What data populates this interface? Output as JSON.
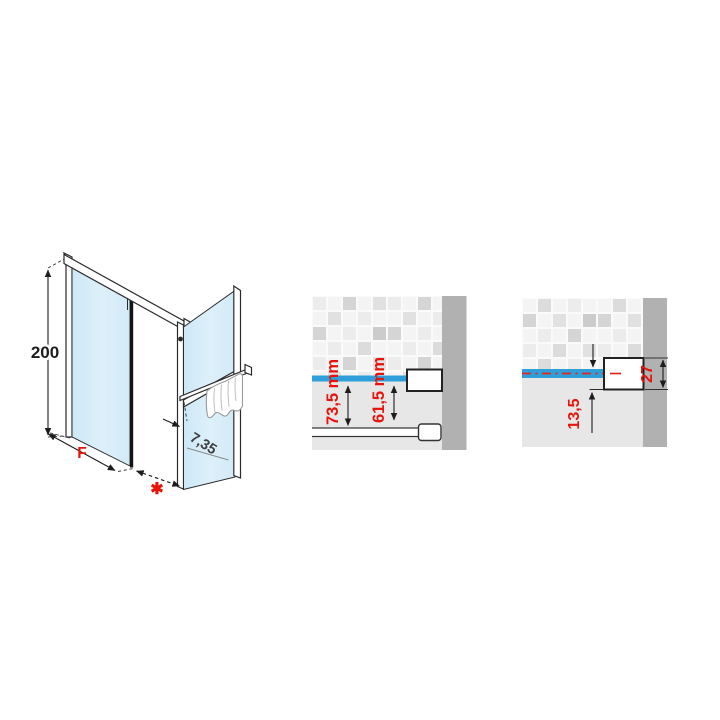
{
  "figure": {
    "type": "technical-diagram",
    "subject": "shower enclosure installation dimension drawing",
    "colors": {
      "accent_red": "#e8140b",
      "rail_blue": "#2e9fd8",
      "glass_blue": "#d7edf8",
      "wall_bar_gray": "#b1b1b1",
      "plaster_gray": "#e7e7e7",
      "line_black": "#2b2b2b"
    },
    "isometric_view": {
      "height_label": "200",
      "fixed_panel_label": "F",
      "extension_label": "✱",
      "glass_offset_label": "7,35"
    },
    "detail_left": {
      "dim_rail_to_bar_outer": "73,5 mm",
      "dim_rail_to_bar_inner": "61,5 mm"
    },
    "detail_right": {
      "dim_centerline_to_bottom": "13,5",
      "dim_bracket_height": "27"
    }
  }
}
